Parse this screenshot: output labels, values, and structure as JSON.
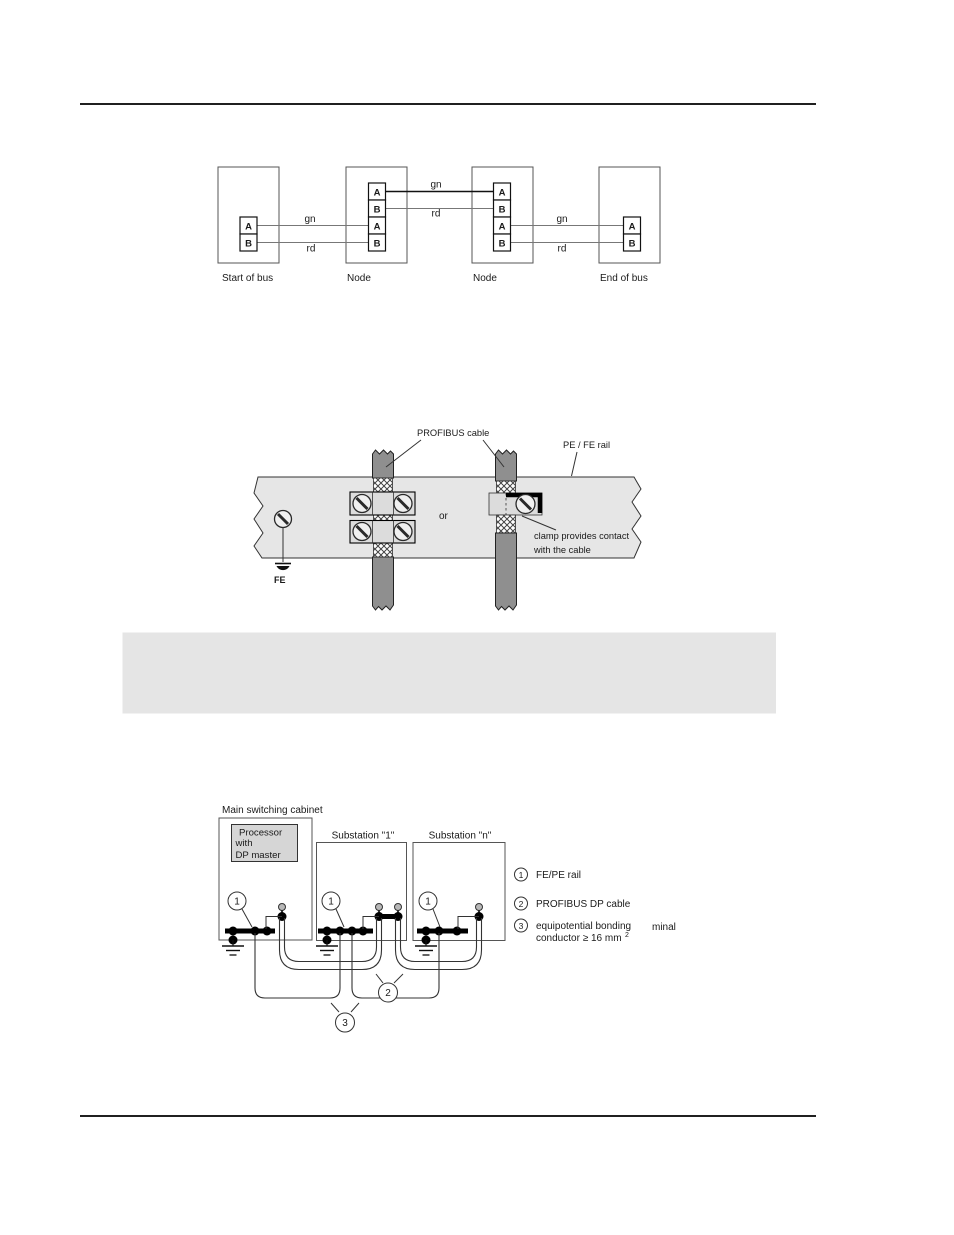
{
  "bus_diagram": {
    "stations": [
      {
        "label": "Start of bus",
        "terminals": [
          "A",
          "B"
        ]
      },
      {
        "label": "Node",
        "terminals": [
          "A",
          "B",
          "A",
          "B"
        ]
      },
      {
        "label": "Node",
        "terminals": [
          "A",
          "B",
          "A",
          "B"
        ]
      },
      {
        "label": "End of bus",
        "terminals": [
          "A",
          "B"
        ]
      }
    ],
    "wire_labels": [
      "gn",
      "rd",
      "gn",
      "rd",
      "gn",
      "rd"
    ]
  },
  "shield_diagram": {
    "cable_label": "PROFIBUS cable",
    "rail_label": "PE / FE rail",
    "or_label": "or",
    "clamp_note": [
      "clamp provides contact",
      "with the cable"
    ],
    "fe_label": "FE"
  },
  "cabinet_diagram": {
    "title": "Main switching cabinet",
    "processor": [
      "Processor",
      "with",
      "DP master"
    ],
    "substations": [
      "Substation \"1\"",
      "Substation \"n\""
    ],
    "callouts": [
      "1",
      "2",
      "3"
    ],
    "legend": [
      {
        "num": "1",
        "lines": [
          "FE/PE rail"
        ]
      },
      {
        "num": "2",
        "lines": [
          "PROFIBUS DP cable"
        ]
      },
      {
        "num": "3",
        "lines": [
          "equipotential bonding",
          "conductor ≥ 16 mm"
        ],
        "superscript": "2",
        "stray_text": "minal"
      }
    ]
  },
  "note_box": {
    "text": ""
  },
  "colors": {
    "rail_gray": "#e6e6e6",
    "cable_gray": "#8f8f8f",
    "clamp_gray": "#dcdcdc",
    "screw_face": "#f0f0f0",
    "note_box_gray": "#e5e5e5",
    "processor_gray": "#d6d6d6",
    "cable_end_gray": "#b8b8b8",
    "line": "#1a1a1a"
  }
}
